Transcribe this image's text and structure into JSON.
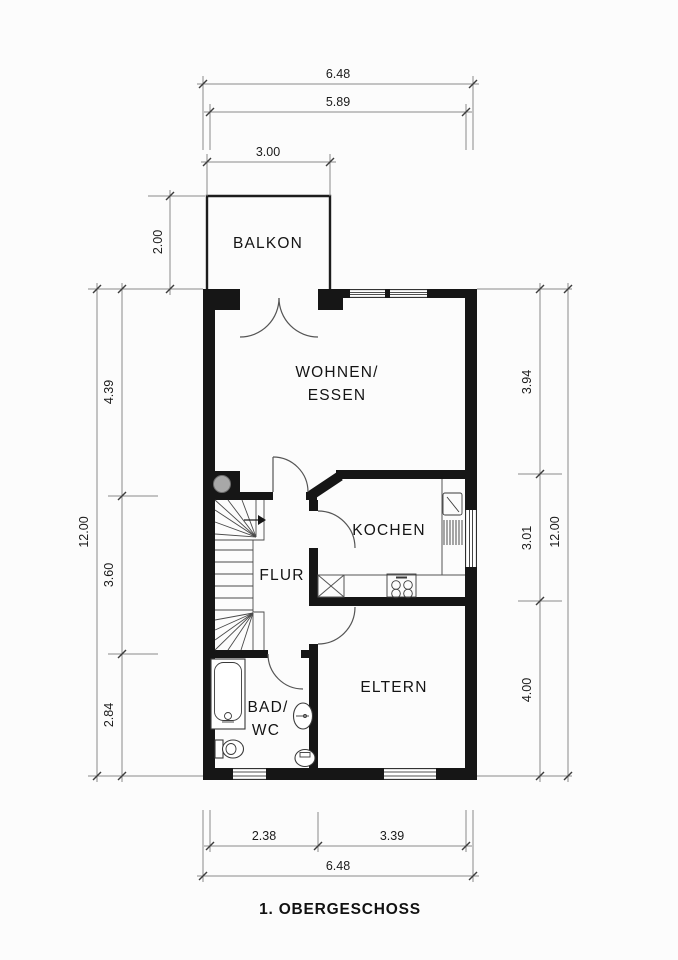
{
  "title": "1. OBERGESCHOSS",
  "rooms": {
    "balkon": "BALKON",
    "wohnen_essen_line1": "WOHNEN/",
    "wohnen_essen_line2": "ESSEN",
    "kochen": "KOCHEN",
    "flur": "FLUR",
    "bad_wc_line1": "BAD/",
    "bad_wc_line2": "WC",
    "eltern": "ELTERN"
  },
  "dimensions_m": {
    "top_outer_width": "6.48",
    "top_inner_width": "5.89",
    "balcony_width": "3.00",
    "balcony_depth": "2.00",
    "left_total_height": "12.00",
    "left_wohnen": "4.39",
    "left_flur": "3.60",
    "left_bad": "2.84",
    "right_total_height": "12.00",
    "right_wohnen": "3.94",
    "right_kochen": "3.01",
    "right_eltern": "4.00",
    "bottom_bad": "2.38",
    "bottom_eltern": "3.39",
    "bottom_outer_width": "6.48"
  },
  "colors": {
    "wall": "#161616",
    "dimension_line": "#8a8a8a",
    "text": "#1b1b1b",
    "chimney_fill": "#a8a8a8",
    "background": "#fcfcfc"
  }
}
